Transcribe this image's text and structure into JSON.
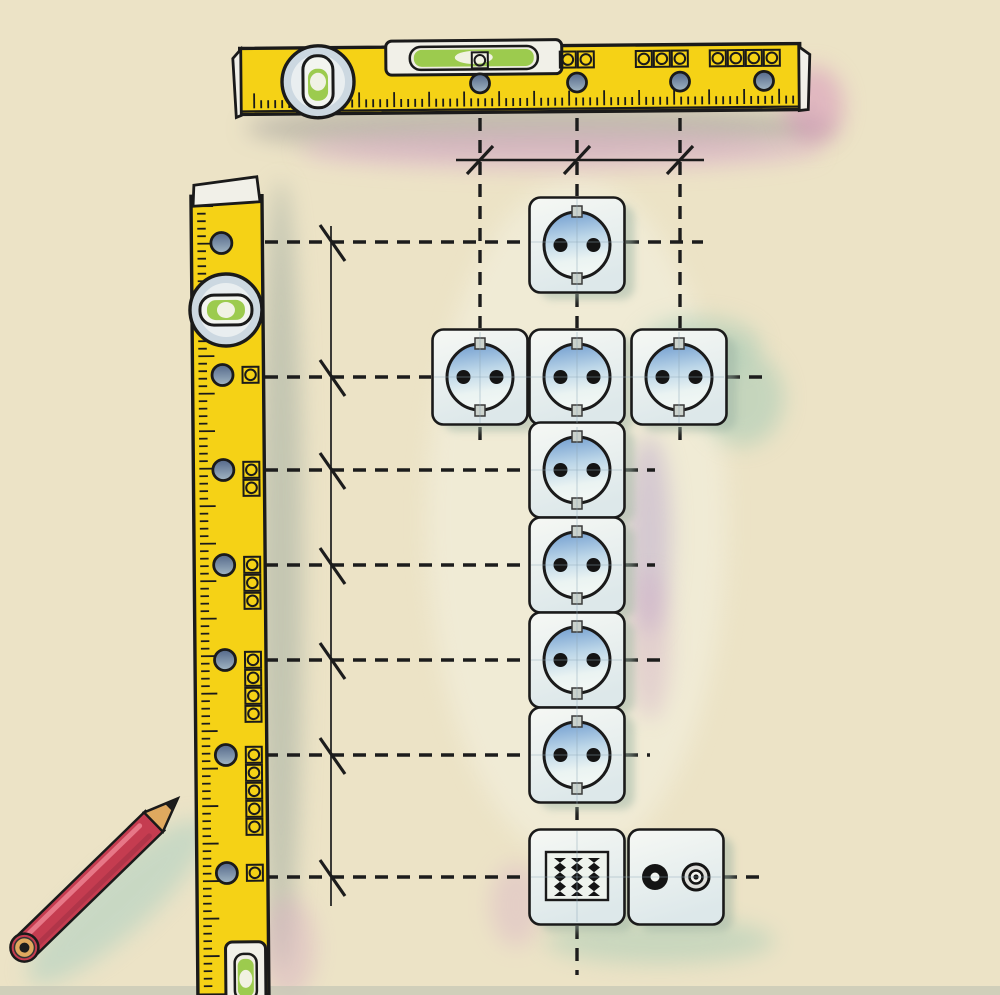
{
  "scene": {
    "width": 1000,
    "height": 995,
    "background": "#ece3c6",
    "bottom_strip_color": "#c2c4b3",
    "description": "illustration of wall sockets laid out with spirit levels and pencil"
  },
  "colors": {
    "yellow": "#f5d216",
    "outline": "#1a1a1a",
    "cap_white": "#f1f0e8",
    "plate_face": "#f6f8f4",
    "plate_edge": "#dde8ea",
    "socket_blue_top": "#6d9ace",
    "socket_blue_mid": "#bcd6e8",
    "socket_blue_low": "#eaf3f2",
    "hole_dark": "#54688a",
    "hole_light": "#a2b6c4",
    "vial_green": "#9ccb4e",
    "vial_face": "#f3f5f0",
    "vial_ring": "#ccd8e1",
    "vial_ring_inner": "#e9eef0",
    "clip_grey": "#cbd2cc",
    "shadow_grey": "#b3afa4",
    "shadow_green": "#a9b2a4",
    "shadow_teal": "#9fc8b4",
    "shadow_violet": "#b9a6cc",
    "shadow_pink": "#ddadca",
    "shadow_magenta": "#d58cba",
    "plate_shadow": "#9db4a4",
    "pencil_red": "#c53c50",
    "pencil_red_hi": "#ea7d8d",
    "pencil_red_dk": "#9e2f44",
    "pencil_wood": "#dfa95f",
    "pencil_tip": "#1d1d1d",
    "pencil_shadow": "#a5cec2",
    "faint_guide": "#8fa8b8",
    "dash_color": "#1c1c1c"
  },
  "horizontal_level": {
    "body": {
      "x": 240,
      "y": 46,
      "w": 560,
      "h": 66
    },
    "tilt_deg": -0.5,
    "ticks": {
      "x_start": 254,
      "x_end": 794,
      "spacing": 7,
      "baseline_y": 106,
      "short": 8,
      "long": 15
    },
    "circle_vial": {
      "cx": 318,
      "cy": 80,
      "r": 36
    },
    "tube_vial": {
      "x": 386,
      "y": 40,
      "w": 176,
      "h": 34
    },
    "holes": [
      480,
      577,
      680,
      764
    ],
    "hole_cy": 83,
    "hole_r": 9.5,
    "marker_groups": [
      {
        "count": 1,
        "center_x": 480
      },
      {
        "count": 2,
        "center_x": 577
      },
      {
        "count": 3,
        "center_x": 662
      },
      {
        "count": 4,
        "center_x": 745
      }
    ],
    "marker_cy": 60
  },
  "vertical_level": {
    "body": {
      "x": 191,
      "y": 196,
      "w": 71,
      "h": 799
    },
    "tilt_deg": -0.5,
    "cap": {
      "x": 193,
      "y": 177,
      "w": 66,
      "h": 25
    },
    "ticks": {
      "y_start": 206,
      "y_end": 990,
      "spacing": 7.5,
      "baseline_x": 197,
      "short": 8.5,
      "long": 16
    },
    "circle_vial": {
      "cx": 225,
      "cy": 310,
      "r": 36
    },
    "bottom_vial": {
      "x": 219,
      "y": 942,
      "w": 40,
      "h": 60
    },
    "holes": [
      243,
      375,
      470,
      565,
      660,
      755,
      873
    ],
    "hole_cx": 221,
    "hole_r": 10.5,
    "marker_counts": [
      0,
      1,
      2,
      3,
      4,
      5,
      1
    ],
    "marker_cx": 249
  },
  "guides": {
    "axis_x": 331,
    "axis_y1": 226,
    "axis_y2": 906,
    "dimension_line": {
      "y": 160,
      "x1": 456,
      "x2": 704
    },
    "top_tick_xs": [
      480,
      577,
      680
    ],
    "left_tick_ys": [
      242,
      377,
      470,
      565,
      660,
      755,
      877
    ],
    "v_dashed": [
      {
        "x": 480,
        "segs": [
          [
            118,
            328
          ],
          [
            427,
            447
          ]
        ]
      },
      {
        "x": 577,
        "segs": [
          [
            118,
            196
          ],
          [
            294,
            328
          ],
          [
            807,
            828
          ],
          [
            926,
            975
          ]
        ]
      },
      {
        "x": 680,
        "segs": [
          [
            118,
            328
          ],
          [
            427,
            447
          ]
        ]
      }
    ],
    "h_dashed": [
      {
        "y": 242,
        "segs": [
          [
            265,
            528
          ],
          [
            626,
            703
          ]
        ]
      },
      {
        "y": 377,
        "segs": [
          [
            265,
            431
          ],
          [
            727,
            763
          ]
        ]
      },
      {
        "y": 470,
        "segs": [
          [
            265,
            528
          ],
          [
            625,
            655
          ]
        ]
      },
      {
        "y": 565,
        "segs": [
          [
            265,
            528
          ],
          [
            625,
            655
          ]
        ]
      },
      {
        "y": 660,
        "segs": [
          [
            265,
            528
          ],
          [
            625,
            668
          ]
        ]
      },
      {
        "y": 755,
        "segs": [
          [
            265,
            528
          ],
          [
            625,
            650
          ]
        ]
      },
      {
        "y": 877,
        "segs": [
          [
            265,
            528
          ],
          [
            724,
            768
          ]
        ]
      }
    ]
  },
  "plates": [
    {
      "type": "socket",
      "cx": 577,
      "cy": 245
    },
    {
      "type": "socket",
      "cx": 480,
      "cy": 377
    },
    {
      "type": "socket",
      "cx": 577,
      "cy": 377
    },
    {
      "type": "socket",
      "cx": 679,
      "cy": 377
    },
    {
      "type": "socket",
      "cx": 577,
      "cy": 470
    },
    {
      "type": "socket",
      "cx": 577,
      "cy": 565
    },
    {
      "type": "socket",
      "cx": 577,
      "cy": 660
    },
    {
      "type": "socket",
      "cx": 577,
      "cy": 755
    },
    {
      "type": "grille",
      "cx": 577,
      "cy": 877
    },
    {
      "type": "tv",
      "cx": 676,
      "cy": 877
    }
  ],
  "plate_size": 95,
  "pencil": {
    "butt": [
      23,
      949
    ],
    "angle_deg": -44.2,
    "body_len": 182,
    "cone_len": 34,
    "width": 27
  }
}
